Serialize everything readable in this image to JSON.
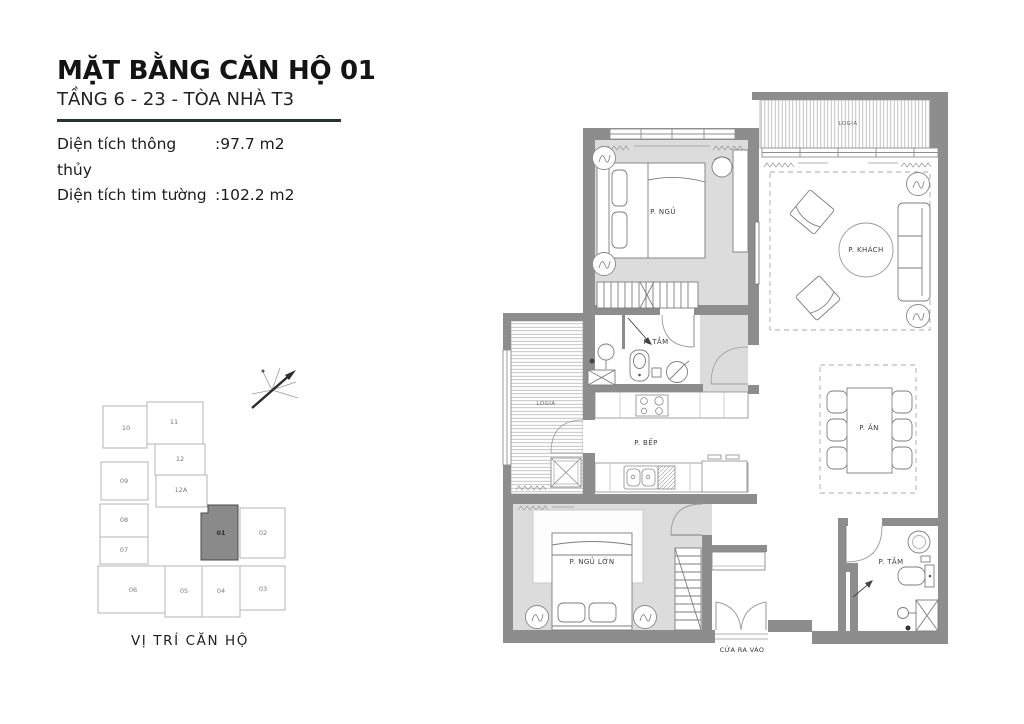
{
  "header": {
    "title": "MẶT BẰNG CĂN HỘ 01",
    "subtitle": "TẦNG 6 - 23 - TÒA NHÀ T3",
    "area_rows": [
      {
        "label": "Diện tích thông thủy",
        "value": ":97.7 m2"
      },
      {
        "label": "Diện tích tim tường",
        "value": ":102.2 m2"
      }
    ]
  },
  "floor_plan": {
    "rooms": {
      "bedroom": "P. NGỦ",
      "living_room": "P. KHÁCH",
      "bathroom_1": "P. TẮM",
      "kitchen": "P. BẾP",
      "dining": "P. ĂN",
      "master_bedroom": "P. NGỦ LỚN",
      "bathroom_2": "P. TẮM",
      "logia_top": "LOGIA",
      "logia_side": "LOGIA",
      "entrance": "CỬA RA VÀO"
    }
  },
  "key_plan": {
    "caption": "VỊ TRÍ CĂN HỘ",
    "highlighted_unit": "01",
    "units": [
      "10",
      "11",
      "09",
      "12",
      "12A",
      "08",
      "07",
      "01",
      "02",
      "06",
      "05",
      "04",
      "03"
    ]
  },
  "colors": {
    "wall": "#8d8d8d",
    "floor": "#dcdcdc",
    "divider": "#233434",
    "highlighted_unit_fill": "#8a8a8a"
  }
}
